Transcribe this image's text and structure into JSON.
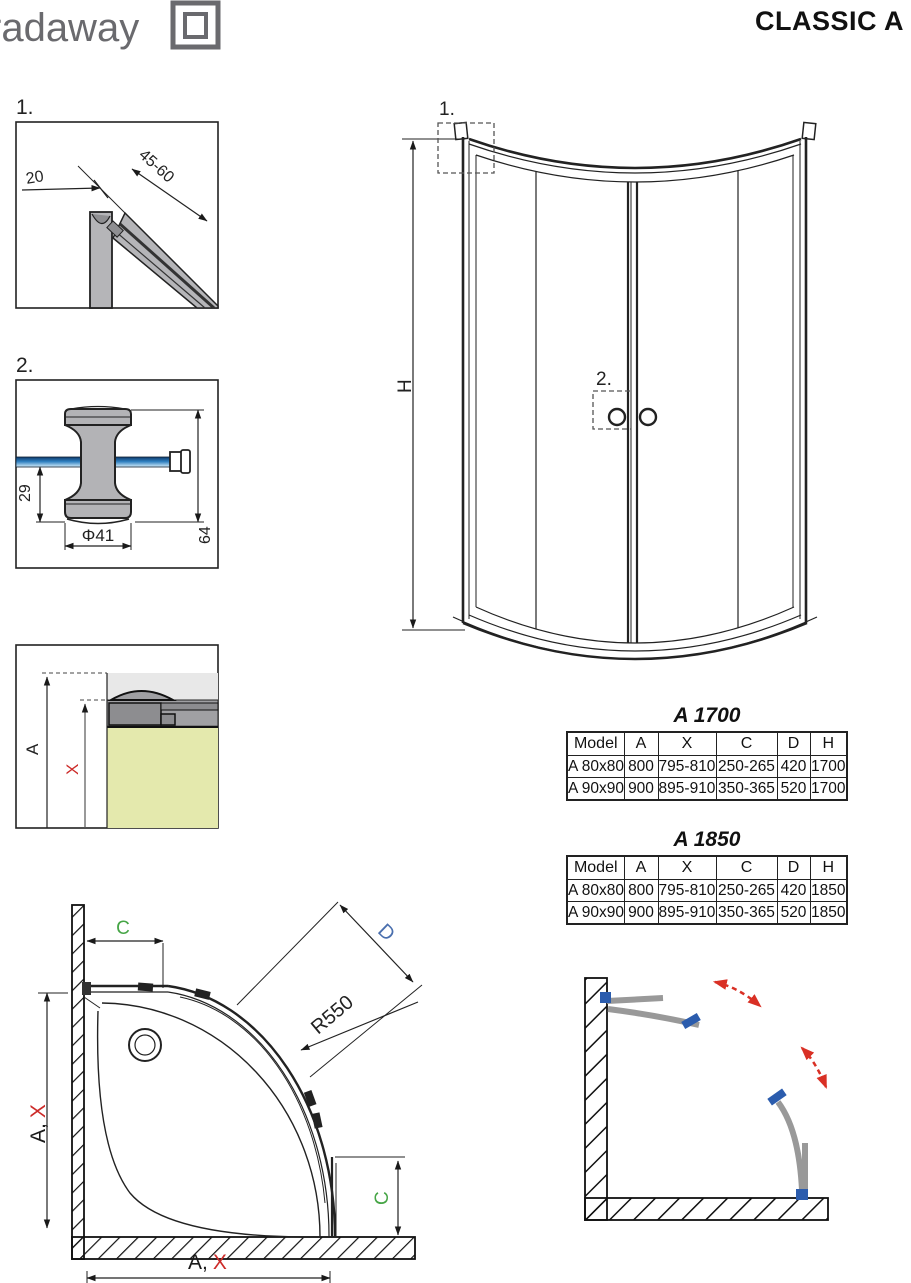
{
  "brand": {
    "logo_text": "radaway",
    "title": "CLASSIC A"
  },
  "detail1": {
    "label": "1.",
    "dim_profile_width": "20",
    "dim_wall_range": "45-60"
  },
  "detail2": {
    "label": "2.",
    "dim_bottom_offset": "29",
    "dim_diameter": "Φ41",
    "dim_height": "64"
  },
  "detail3": {
    "dim_a": "A",
    "dim_x": "X"
  },
  "elevation": {
    "marker_1": "1.",
    "marker_2": "2.",
    "dim_height": "H"
  },
  "tables": [
    {
      "title": "A 1700",
      "headers": [
        "Model",
        "A",
        "X",
        "C",
        "D",
        "H"
      ],
      "rows": [
        [
          "A 80x80",
          "800",
          "795-810",
          "250-265",
          "420",
          "1700"
        ],
        [
          "A 90x90",
          "900",
          "895-910",
          "350-365",
          "520",
          "1700"
        ]
      ]
    },
    {
      "title": "A 1850",
      "headers": [
        "Model",
        "A",
        "X",
        "C",
        "D",
        "H"
      ],
      "rows": [
        [
          "A 80x80",
          "800",
          "795-810",
          "250-265",
          "420",
          "1850"
        ],
        [
          "A 90x90",
          "900",
          "895-910",
          "350-365",
          "520",
          "1850"
        ]
      ]
    }
  ],
  "plan": {
    "dim_c_top": "C",
    "dim_d": "D",
    "dim_radius": "R550",
    "dim_c_right": "C",
    "left_dim": {
      "a": "A,",
      "x": "X"
    },
    "bottom_dim": {
      "a": "A,",
      "x": "X"
    }
  },
  "colors": {
    "logo_gray": "#6a6a6e",
    "line_black": "#1a1a1a",
    "dim_red": "#cc2a28",
    "dim_green": "#46a546",
    "table_green": "#8bc34a",
    "dim_blue": "#4a6fae",
    "table_blue": "#5b7fb5",
    "profile_gray": "#b5b5b8",
    "tray_olive": "#e4e9ad",
    "glass_blue_dark": "#0e3a6b",
    "glass_blue_light": "#d6eefb",
    "handle_blue": "#2b5cad",
    "arrow_red": "#d93025",
    "door_gray": "#999999"
  }
}
